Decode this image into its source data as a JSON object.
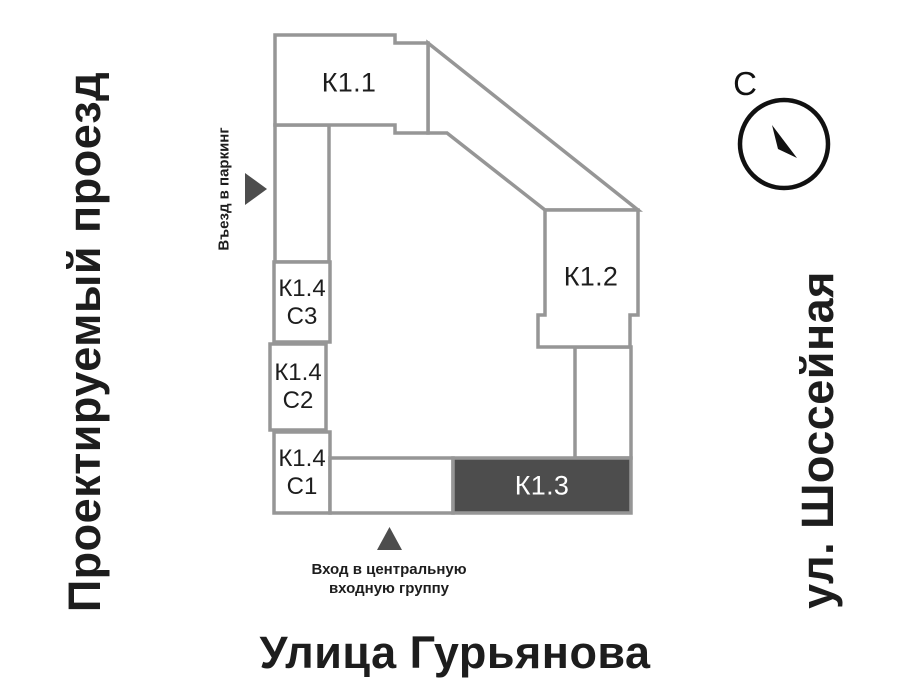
{
  "streets": {
    "left": "Проектируемый проезд",
    "right": "ул. Шоссейная",
    "bottom": "Улица Гурьянова"
  },
  "buildings": {
    "k11": {
      "label": "К1.1"
    },
    "k12": {
      "label": "К1.2"
    },
    "k13": {
      "label": "К1.3",
      "highlighted": true
    },
    "k14_s3": {
      "line1": "К1.4",
      "line2": "С3"
    },
    "k14_s2": {
      "line1": "К1.4",
      "line2": "С2"
    },
    "k14_s1": {
      "line1": "К1.4",
      "line2": "С1"
    }
  },
  "annotations": {
    "parking_entrance": {
      "label": "Въезд в паркинг",
      "icon": "arrow-right-triangle"
    },
    "main_entrance": {
      "line1": "Вход в центральную",
      "line2": "входную группу",
      "icon": "arrow-up-triangle"
    }
  },
  "compass": {
    "north_letter": "С",
    "icon": "compass-needle"
  },
  "colors": {
    "building_outline": "#969696",
    "highlight_fill": "#4d4d4d",
    "arrow_fill": "#4d4d4d",
    "text": "#1d1d1d",
    "compass_ink": "#111111",
    "background": "#ffffff"
  }
}
